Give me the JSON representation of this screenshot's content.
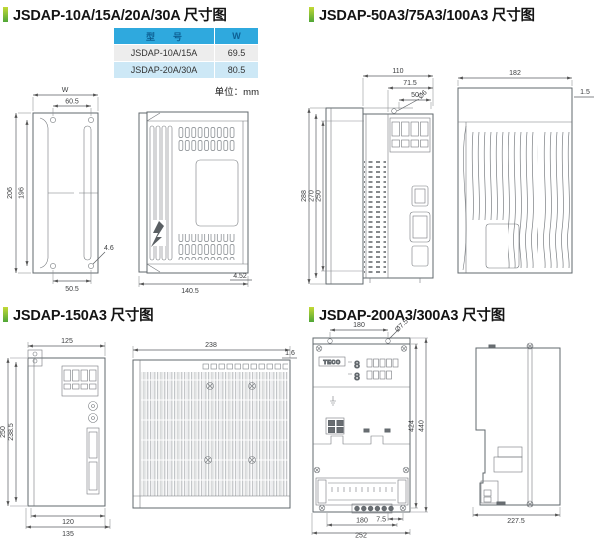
{
  "page": {
    "background": "#ffffff"
  },
  "colors": {
    "accent_top": "#c3d935",
    "accent_bottom": "#4fa637",
    "table_header_bg": "#2fa9de",
    "table_header_text": "#0d6094",
    "table_row_bg": "#ededed",
    "table_row_alt_bg": "#cde8f6"
  },
  "sections": {
    "s1": {
      "title": "JSDAP-10A/15A/20A/30A 尺寸图",
      "table": {
        "col_model": "型　　号",
        "col_w": "W",
        "rows": [
          {
            "model": "JSDAP-10A/15A",
            "w": "69.5"
          },
          {
            "model": "JSDAP-20A/30A",
            "w": "80.5"
          }
        ],
        "unit_label": "单位：mm"
      },
      "dims": {
        "width_top": "W",
        "hole_span_top": "60.5",
        "height_outer": "206",
        "height_inner": "196",
        "hole_dia": "4.6",
        "hole_span_bottom": "50.5",
        "depth": "140.5",
        "foot": "4.52"
      }
    },
    "s2": {
      "title": "JSDAP-50A3/75A3/100A3 尺寸图",
      "dims": {
        "top_outer": "110",
        "top_mid": "71.5",
        "top_inner": "50",
        "hole_dia": "Ø6",
        "height_outer": "288",
        "height_mid": "270",
        "height_inner": "250",
        "depth": "182",
        "panel_thickness": "1.5"
      }
    },
    "s3": {
      "title": "JSDAP-150A3 尺寸图",
      "dims": {
        "width_top": "125",
        "height_outer": "250",
        "height_inner": "238.5",
        "bottom_inner": "120",
        "bottom_outer": "135",
        "depth": "238",
        "panel_thickness": "1.6"
      }
    },
    "s4": {
      "title": "JSDAP-200A3/300A3 尺寸图",
      "logo": "TECO",
      "digit_top": "8",
      "digit_bottom": "8",
      "dims": {
        "top_hole_span": "180",
        "hole_dia": "Ø7.5",
        "height_inner": "424",
        "height_outer": "440",
        "bottom_offset": "7.5",
        "bottom_hole_span": "180",
        "bottom_outer": "252",
        "depth": "227.5"
      }
    }
  }
}
